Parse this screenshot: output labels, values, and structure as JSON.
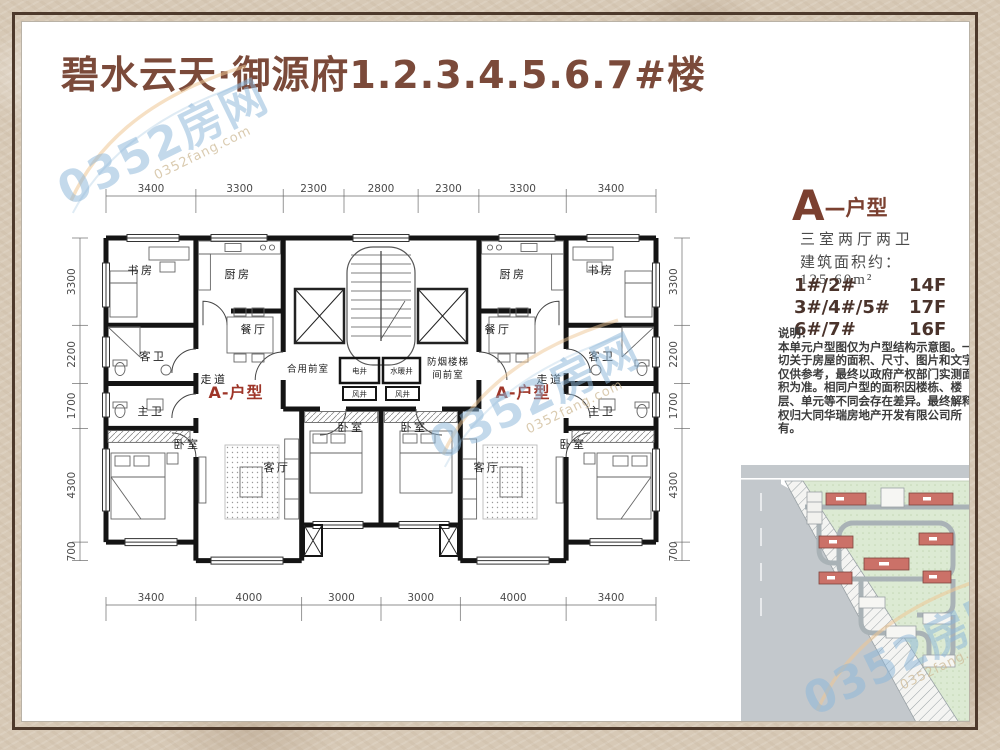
{
  "page": {
    "title": "碧水云天·御源府1.2.3.4.5.6.7#楼"
  },
  "watermark": {
    "text": "0352房网",
    "subtext": "0352fang.com"
  },
  "floor_plan": {
    "dims_top": [
      "3400",
      "3300",
      "2300",
      "2800",
      "2300",
      "3300",
      "3400"
    ],
    "dims_bottom": [
      "3400",
      "4000",
      "3000",
      "3000",
      "4000",
      "3400"
    ],
    "dims_side": [
      "3300",
      "2200",
      "1700",
      "4300",
      "700"
    ],
    "unit_label": "A-户型",
    "rooms": {
      "study": "书房",
      "kitchen": "厨房",
      "dining": "餐厅",
      "guest_bath": "客卫",
      "corridor": "走道",
      "master_bath": "主卫",
      "bedroom": "卧室",
      "living": "客厅",
      "shared_front_room": "合用前室",
      "smoke_stair_l1": "防烟楼梯",
      "smoke_stair_l2": "间前室",
      "electrical_shaft": "电井",
      "plumbing_shaft": "水暖井",
      "air_shaft": "风井"
    }
  },
  "info_panel": {
    "type_letter": "A",
    "type_suffix": "—户型",
    "layout": "三室两厅两卫",
    "area_line": "建筑面积约：125.60m²",
    "floors": [
      {
        "buildings": "1#/2#",
        "height": "14F"
      },
      {
        "buildings": "3#/4#/5#",
        "height": "17F"
      },
      {
        "buildings": "6#/7#",
        "height": "16F"
      }
    ],
    "note_title": "说明：",
    "note_body": "本单元户型图仅为户型结构示意图。一切关于房屋的面积、尺寸、图片和文字仅供参考，最终以政府产权部门实测面积为准。相同户型的面积因楼栋、楼层、单元等不同会存在差异。最终解释权归大同华瑞房地产开发有限公司所有。"
  }
}
